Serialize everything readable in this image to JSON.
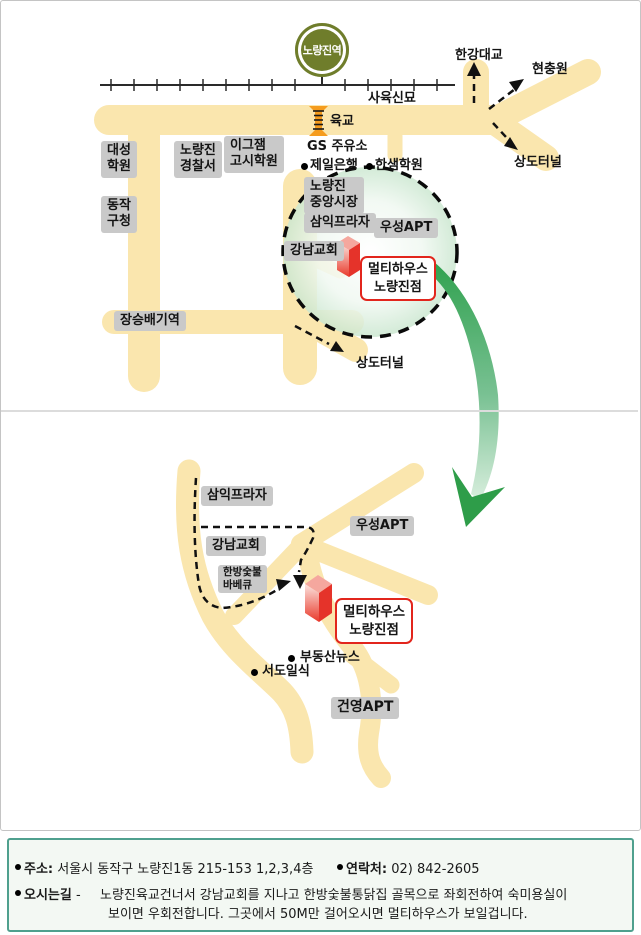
{
  "top_map": {
    "station_badge": "노량진역",
    "railway_site": "사육신묘",
    "hangang_bridge": "한강대교",
    "hyeonchungwon": "현충원",
    "sangdo_tunnel_ne": "상도터널",
    "footbridge": "육교",
    "gs_gas_station": "GS 주유소",
    "jeil_bank": "제일은행",
    "hansaem_academy": "한샘학원",
    "daesung_academy": "대성\n학원",
    "police_station": "노량진\n경찰서",
    "exam_academy": "이그잼\n고시학원",
    "dongjak_office": "동작\n구청",
    "central_market": "노량진\n중앙시장",
    "samik_plaza": "삼익프라자",
    "wooseong_apt": "우성APT",
    "gangnam_church": "강남교회",
    "store": "멀티하우스\n노량진점",
    "jangseungbaegi": "장승배기역",
    "sangdo_tunnel_s": "상도터널"
  },
  "bottom_map": {
    "samik_plaza": "삼익프라자",
    "wooseong_apt": "우성APT",
    "gangnam_church": "강남교회",
    "bbq_restaurant": "한방숯불\n바베큐",
    "store": "멀티하우스\n노량진점",
    "budongsan_news": "부동산뉴스",
    "seodo_ilsik": "서도일식",
    "gunyoung_apt": "건영APT"
  },
  "footer": {
    "address_label": "주소:",
    "address_value": "서울시 동작구 노량진1동 215-153 1,2,3,4층",
    "contact_label": "연락처:",
    "contact_value": "02) 842-2605",
    "directions_label": "오시는길",
    "directions_dash": "-",
    "directions_line1": "노량진육교건너서 강남교회를 지나고 한방숯불통닭집 골목으로 좌회전하여 숙미용실이",
    "directions_line2": "보이면 우회전합니다. 그곳에서 50M만 걸어오시면 멀티하우스가 보일겁니다."
  },
  "colors": {
    "road_yellow": "#FAE6AE",
    "label_gray": "#C9C9C9",
    "store_red_border": "#E2251C",
    "building_red": "#E5332A",
    "station_olive": "#6F7D2B",
    "footbridge_orange": "#F59C1E",
    "swoosh_green": "#2FA14E",
    "footer_border_teal": "#4FA08E"
  }
}
